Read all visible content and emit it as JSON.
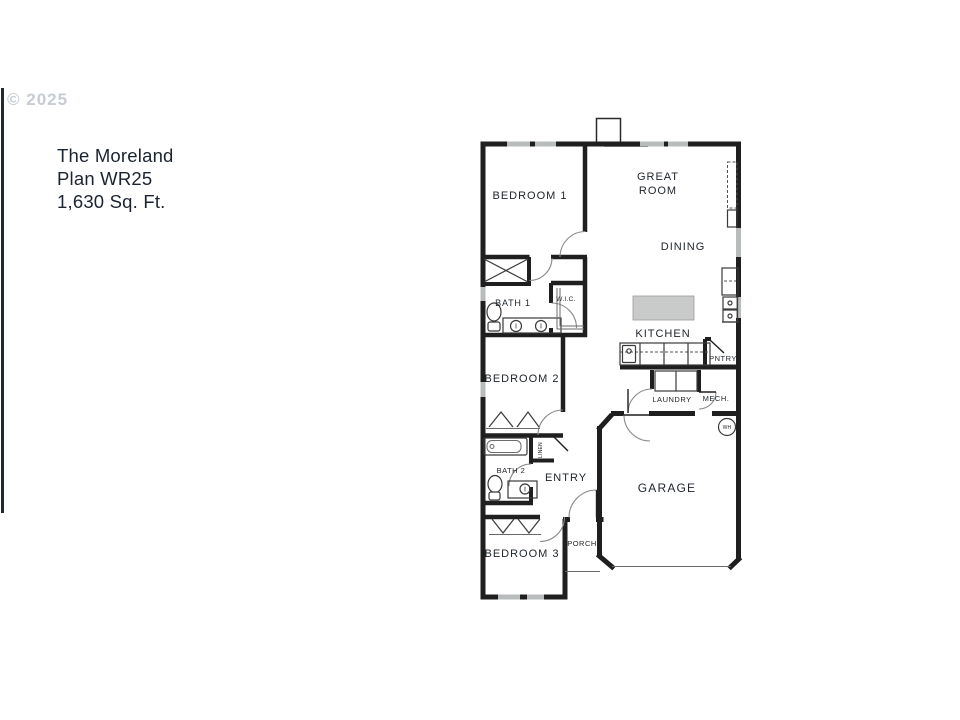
{
  "watermark": {
    "copyright": "© 2025"
  },
  "title": {
    "line1": "The Moreland",
    "line2": "Plan WR25",
    "line3": "1,630 Sq. Ft."
  },
  "floorplan": {
    "rooms": {
      "bedroom1": "BEDROOM 1",
      "great_room_line1": "GREAT",
      "great_room_line2": "ROOM",
      "dining": "DINING",
      "bath1": "BATH 1",
      "wic": "W.I.C.",
      "kitchen": "KITCHEN",
      "pantry": "PNTRY",
      "bedroom2": "BEDROOM 2",
      "laundry": "LAUNDRY",
      "mech": "MECH.",
      "water_heater": "WH",
      "linen": "LINEN",
      "bath2": "BATH 2",
      "entry": "ENTRY",
      "garage": "GARAGE",
      "porch": "PORCH",
      "bedroom3": "BEDROOM 3"
    },
    "colors": {
      "wall": "#1f1f1f",
      "window": "#b9bcbd",
      "island_fill": "#c9cbcb",
      "label_text": "#20262b",
      "edge_line": "#1f2a36",
      "watermark_text": "#c6ccd2"
    }
  }
}
